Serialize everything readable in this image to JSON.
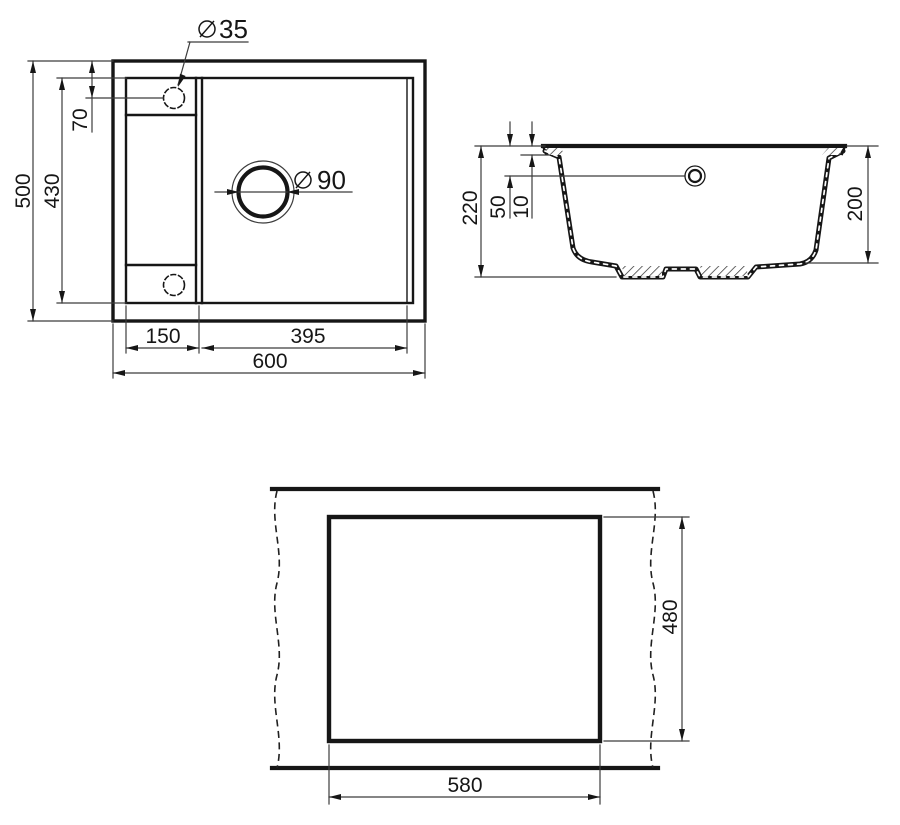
{
  "drawing": {
    "plan": {
      "tap_hole_diameter": "35",
      "drain_hole_diameter": "90",
      "overall_width": "600",
      "overall_depth": "500",
      "inner_depth": "430",
      "tap_hole_offset": "70",
      "drainer_width": "150",
      "bowl_width": "395"
    },
    "section": {
      "overall_height": "220",
      "overflow_offset": "50",
      "rim_thickness": "10",
      "bowl_depth": "200"
    },
    "cutout": {
      "cutout_width": "580",
      "cutout_depth": "480"
    }
  }
}
